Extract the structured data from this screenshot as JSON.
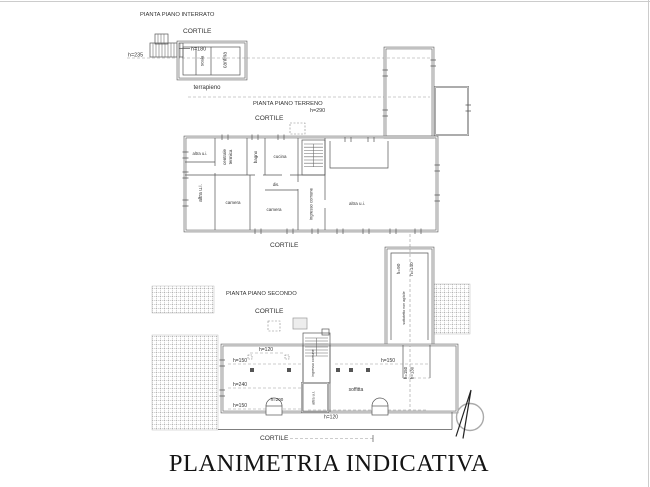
{
  "drawing_title": "PLANIMETRIA INDICATIVA",
  "interrato": {
    "title": "PIANTA PIANO INTERRATO",
    "cortile": "CORTILE",
    "h_235": "h=235",
    "h_180": "h=180",
    "scala": "scala",
    "cantina": "cantina",
    "terrapieno": "terrapieno"
  },
  "terreno": {
    "title": "PIANTA PIANO TERRENO",
    "h_290": "h=290",
    "cortile_top": "CORTILE",
    "cortile_bottom": "CORTILE",
    "altra_ui_top": "altra u.i.",
    "altra_ui_left": "altra u.i.",
    "centrale_termica": {
      "line1": "centrale",
      "line2": "termica"
    },
    "bagno": "bagno",
    "cucina": "cucina",
    "dis": "dis.",
    "camera_1": "camera",
    "camera_2": "camera",
    "ingresso_comune": "ingresso comune",
    "altra_ui_right": "altra u.i."
  },
  "secondo": {
    "title": "PIANTA PIANO SECONDO",
    "cortile_top": "CORTILE",
    "cortile_bottom": "CORTILE",
    "h_90": "h=90",
    "h_140": "h=140",
    "ridge_note": "sottotetto non agibile",
    "h_120_top": "h=120",
    "h_150_left": "h=150",
    "h_150_right": "h=150",
    "h_240": "h=240",
    "h_200": "h=200",
    "h_150_bottom": "h=150",
    "h_120_bottom": "h=120",
    "h_150_vert": "h=150",
    "h_130_vert": "h=130",
    "soffitta": "soffitta",
    "ingresso_comune": "ingresso comune",
    "altra_ui": "altra u.i."
  }
}
